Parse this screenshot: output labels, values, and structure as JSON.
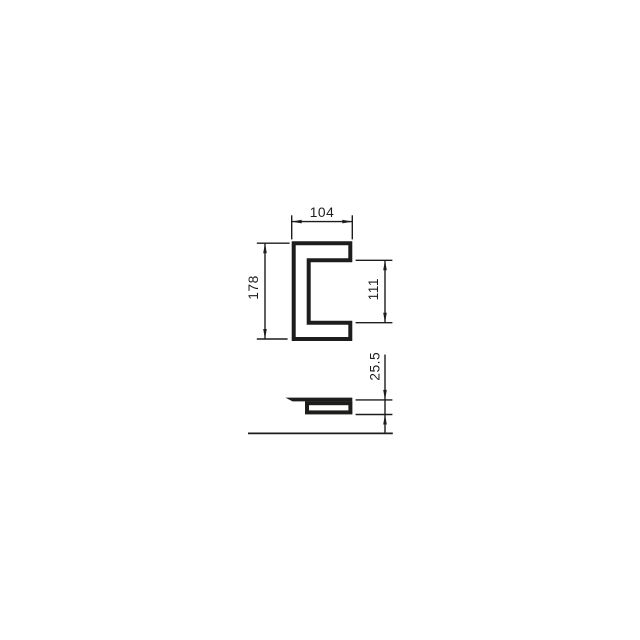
{
  "canvas": {
    "background_color": "#ffffff",
    "line_color": "#1d1d1b"
  },
  "front_view": {
    "shape": "c-profile-cross-section",
    "dimensions": {
      "width": {
        "label": "104",
        "position": "top",
        "orientation": "horizontal"
      },
      "height": {
        "label": "178",
        "position": "left",
        "orientation": "vertical"
      },
      "opening_height": {
        "label": "111",
        "position": "right",
        "orientation": "vertical"
      }
    }
  },
  "side_view": {
    "shape": "profile-depth-section",
    "dimensions": {
      "depth": {
        "label": "25.5",
        "position": "right",
        "orientation": "vertical"
      }
    }
  }
}
